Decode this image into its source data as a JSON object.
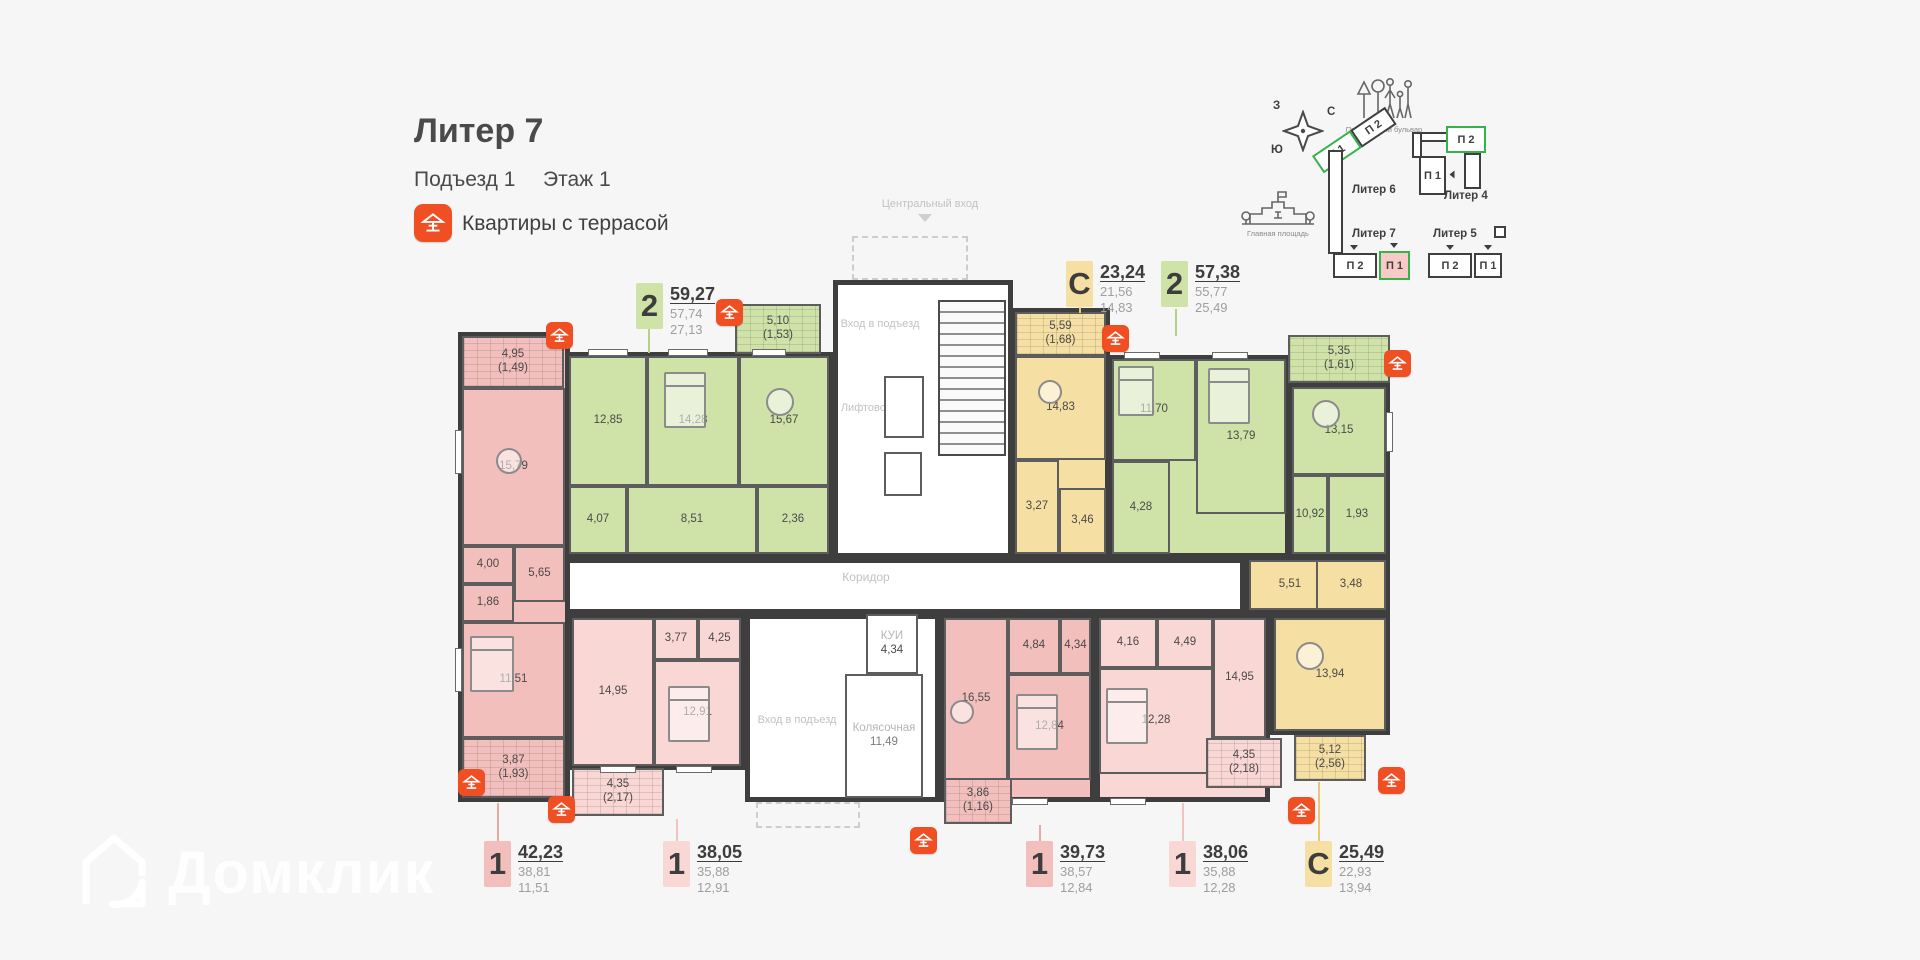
{
  "header": {
    "title": "Литер 7",
    "entrance": "Подъезд 1",
    "floor": "Этаж 1",
    "terrace_note": "Квартиры с террасой"
  },
  "watermark": {
    "text": "Домклик"
  },
  "colors": {
    "accent_red": "#f04f24",
    "apt_green": "#cfe3a8",
    "apt_yellow": "#f6dfa2",
    "apt_pink": "#f3bfbd",
    "apt_pink_light": "#f9d7d4",
    "minimap_selected_green": "#35b34a"
  },
  "minimap": {
    "compass": {
      "w": "З",
      "n": "С",
      "s": "Ю",
      "e": "В"
    },
    "boulevard": "Прогулочный бульвар",
    "square": "Главная площадь",
    "liters": {
      "l6": {
        "name": "Литер 6",
        "p1": "П 1",
        "p2": "П 2"
      },
      "l4": {
        "name": "Литер 4",
        "p1": "П 1",
        "p2": "П 2"
      },
      "l7": {
        "name": "Литер 7",
        "p1": "П 1",
        "p2": "П 2"
      },
      "l5": {
        "name": "Литер 5",
        "p1": "П 1",
        "p2": "П 2"
      }
    }
  },
  "plan": {
    "central_entrance": "Центральный вход",
    "entrance_top": "Вход в подъезд",
    "entrance_bottom": "Вход в подъезд",
    "lift_hall": "Лифтовой холл",
    "corridor": "Коридор",
    "kui_name": "КУИ",
    "kui_area": "4,34",
    "stroller_name": "Колясочная",
    "stroller_area": "11,49"
  },
  "apartments": [
    {
      "type": "2",
      "v1": "59,27",
      "v2": "57,74",
      "v3": "27,13",
      "rooms": {
        "r1": "12,85",
        "r2": "14,28",
        "r3": "15,67",
        "r4": "4,07",
        "r5": "8,51",
        "r6": "2,36"
      },
      "terr": {
        "a": "5,10",
        "b": "(1,53)"
      }
    },
    {
      "type": "С",
      "v1": "23,24",
      "v2": "21,56",
      "v3": "14,83",
      "rooms": {
        "r1": "14,83",
        "r2": "3,27",
        "r3": "3,46"
      },
      "terr": {
        "a": "5,59",
        "b": "(1,68)"
      }
    },
    {
      "type": "2",
      "v1": "57,38",
      "v2": "55,77",
      "v3": "25,49",
      "rooms": {
        "r1": "11,70",
        "r2": "13,79",
        "r3": "4,28",
        "r4": "13,15",
        "r5": "10,92",
        "r6": "1,93"
      },
      "terr": {
        "a": "5,35",
        "b": "(1,61)"
      }
    },
    {
      "type": "1",
      "v1": "42,23",
      "v2": "38,81",
      "v3": "11,51",
      "rooms": {
        "r1": "15,79",
        "r2": "4,00",
        "r3": "5,65",
        "r4": "1,86",
        "r5": "11,51"
      },
      "terr": {
        "a": "4,95",
        "b": "(1,49)"
      },
      "terr2": {
        "a": "3,87",
        "b": "(1,93)"
      }
    },
    {
      "type": "1",
      "v1": "38,05",
      "v2": "35,88",
      "v3": "12,91",
      "rooms": {
        "r1": "14,95",
        "r2": "3,77",
        "r3": "4,25",
        "r4": "12,91"
      },
      "terr": {
        "a": "4,35",
        "b": "(2,17)"
      }
    },
    {
      "type": "1",
      "v1": "39,73",
      "v2": "38,57",
      "v3": "12,84",
      "rooms": {
        "r1": "16,55",
        "r2": "4,84",
        "r3": "4,34",
        "r4": "12,84"
      },
      "terr": {
        "a": "3,86",
        "b": "(1,16)"
      }
    },
    {
      "type": "1",
      "v1": "38,06",
      "v2": "35,88",
      "v3": "12,28",
      "rooms": {
        "r1": "4,16",
        "r2": "4,49",
        "r3": "14,95",
        "r4": "12,28"
      },
      "terr": {
        "a": "4,35",
        "b": "(2,18)"
      }
    },
    {
      "type": "С",
      "v1": "25,49",
      "v2": "22,93",
      "v3": "13,94",
      "rooms": {
        "r1": "5,51",
        "r2": "3,48",
        "r3": "13,94"
      },
      "terr": {
        "a": "5,12",
        "b": "(2,56)"
      }
    }
  ]
}
